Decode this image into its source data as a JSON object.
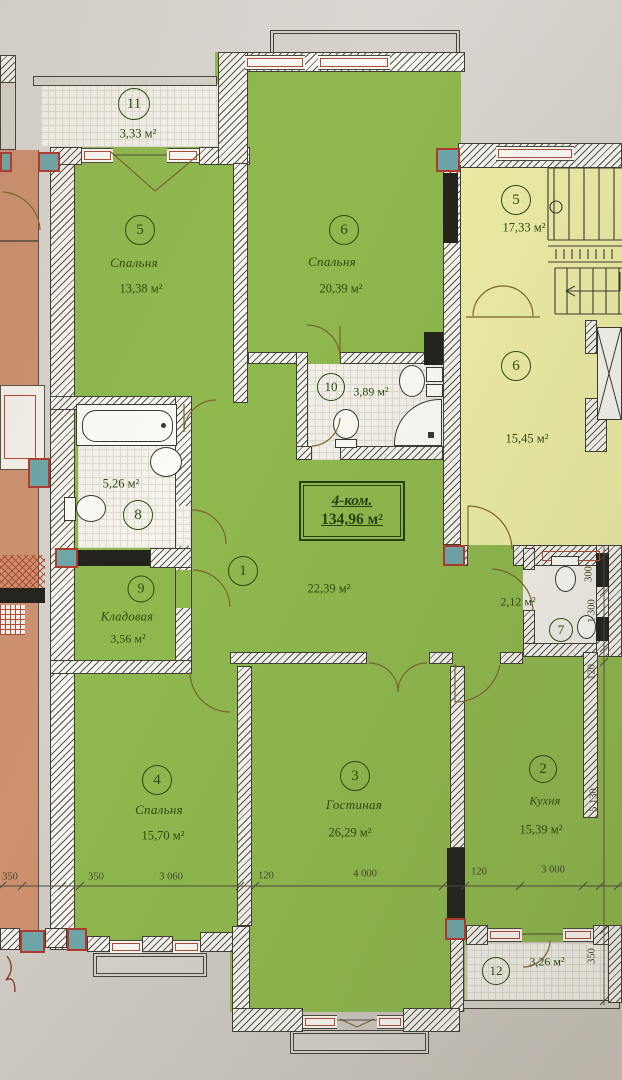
{
  "document": {
    "type_label": "4-ком.",
    "total_area": "134,96 м²"
  },
  "rooms": [
    {
      "number": "11",
      "name": "",
      "area": "3,33 м²"
    },
    {
      "number": "5",
      "name": "Спальня",
      "area": "13,38 м²"
    },
    {
      "number": "6",
      "name": "Спальня",
      "area": "20,39 м²"
    },
    {
      "number": "5",
      "name": "",
      "area": "17,33 м²"
    },
    {
      "number": "6",
      "name": "",
      "area": "15,45 м²"
    },
    {
      "number": "10",
      "name": "",
      "area": "3,89 м²"
    },
    {
      "number": "8",
      "name": "",
      "area": "5,26 м²"
    },
    {
      "number": "9",
      "name": "Кладовая",
      "area": "3,56 м²"
    },
    {
      "number": "1",
      "name": "",
      "area": "22,39 м²"
    },
    {
      "number": "7",
      "name": "",
      "area": "2,12 м²"
    },
    {
      "number": "4",
      "name": "Спальня",
      "area": "15,70 м²"
    },
    {
      "number": "3",
      "name": "Гостиная",
      "area": "26,29 м²"
    },
    {
      "number": "2",
      "name": "Кухня",
      "area": "15,39 м²"
    },
    {
      "number": "12",
      "name": "",
      "area": "3,26 м²"
    }
  ],
  "dimensions": {
    "bottom": [
      "350",
      "350",
      "3 060",
      "120",
      "4 000",
      "120",
      "3 000"
    ],
    "right": [
      "300",
      "1 300",
      "120",
      "5 130",
      "350"
    ]
  },
  "colors": {
    "room_green": "#8fb94e",
    "common_yellow": "#edeea7",
    "adjacent_orange": "#cd9170",
    "column_teal": "#6fa7aa",
    "window_red": "#b14a34",
    "paper": "#d6d2cb",
    "label_green": "#2f4a0e"
  }
}
